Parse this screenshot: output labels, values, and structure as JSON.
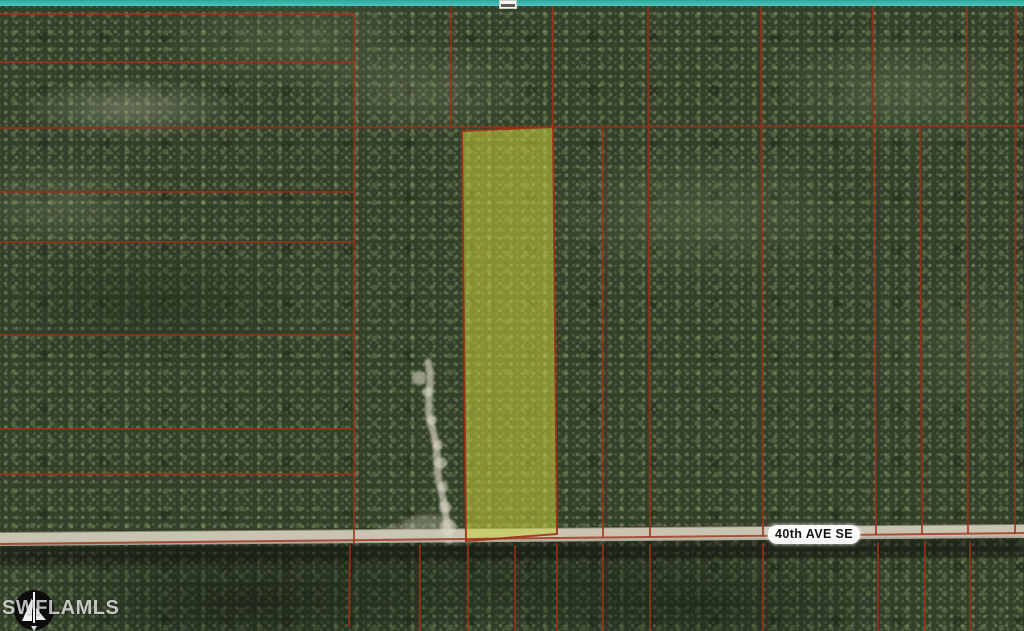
{
  "map": {
    "description": "Aerial view of forested acreage with red parcel boundary overlay, one lot highlighted",
    "width": 1024,
    "height": 631,
    "road": {
      "label": "40th AVE SE",
      "label_x": 768,
      "label_y": 525
    },
    "watermark": {
      "text": "SWFLAMLS",
      "icon": "compass-north",
      "text_x": 2,
      "text_y": 597,
      "compass_cx": 34,
      "compass_cy": 610,
      "compass_r": 20
    },
    "colors": {
      "boundary": "#9e3018",
      "parcel_highlight": "#c9d23e",
      "road_surface": "#c9c4b2",
      "road_shadow": "rgba(10,14,8,0.42)",
      "forest_base": "#33402a",
      "teal_border": "#3db6ab",
      "trail": "#d9d4c2",
      "label_bg": "#ffffff",
      "label_text": "#141414",
      "watermark_white": "rgba(255,255,255,0.72)"
    },
    "highlighted_parcel": {
      "points": "462,131 553,127 557,534 466,541",
      "fill_opacity": 0.55
    },
    "road_band": {
      "surface_points": "0,532 1024,524 1024,538 0,546",
      "shadow_points": "0,546 1024,538 1024,557 0,565"
    },
    "boundary_lines": [
      [
        0,
        14,
        354,
        14
      ],
      [
        0,
        62,
        354,
        62
      ],
      [
        0,
        128,
        1024,
        126
      ],
      [
        0,
        192,
        354,
        192
      ],
      [
        0,
        242,
        354,
        242
      ],
      [
        0,
        335,
        354,
        335
      ],
      [
        0,
        429,
        354,
        429
      ],
      [
        0,
        474,
        354,
        474
      ],
      [
        354,
        14,
        354,
        543
      ],
      [
        451,
        6,
        451,
        128
      ],
      [
        553,
        6,
        553,
        128
      ],
      [
        648,
        6,
        650,
        536
      ],
      [
        761,
        6,
        763,
        535
      ],
      [
        873,
        6,
        876,
        534
      ],
      [
        967,
        6,
        968,
        533
      ],
      [
        1016,
        6,
        1015,
        533
      ],
      [
        603,
        127,
        603,
        536
      ],
      [
        920,
        127,
        922,
        534
      ],
      [
        0,
        544,
        1024,
        533
      ],
      [
        350,
        546,
        349,
        626
      ],
      [
        420,
        546,
        420,
        631
      ],
      [
        468,
        546,
        468,
        631
      ],
      [
        515,
        546,
        515,
        631
      ],
      [
        557,
        545,
        557,
        631
      ],
      [
        603,
        545,
        603,
        631
      ],
      [
        650,
        545,
        650,
        631
      ],
      [
        763,
        544,
        763,
        631
      ],
      [
        878,
        543,
        878,
        631
      ],
      [
        925,
        543,
        925,
        631
      ],
      [
        970,
        542,
        970,
        631
      ]
    ],
    "trail": {
      "path": "M428,362 C434,386 424,406 432,428 C440,450 435,470 441,490 C445,507 447,522 449,540",
      "dots": [
        [
          419,
          378,
          7
        ],
        [
          427,
          392,
          5
        ],
        [
          432,
          420,
          5
        ],
        [
          438,
          445,
          5
        ],
        [
          441,
          463,
          6
        ],
        [
          443,
          487,
          5
        ],
        [
          445,
          507,
          6
        ],
        [
          448,
          527,
          8
        ]
      ],
      "clearings": [
        [
          428,
          524,
          26,
          9
        ],
        [
          398,
          533,
          24,
          7
        ],
        [
          455,
          536,
          20,
          7
        ]
      ]
    },
    "top_marker_box": {
      "x": 499,
      "y": 0,
      "w": 18,
      "h": 9
    }
  }
}
